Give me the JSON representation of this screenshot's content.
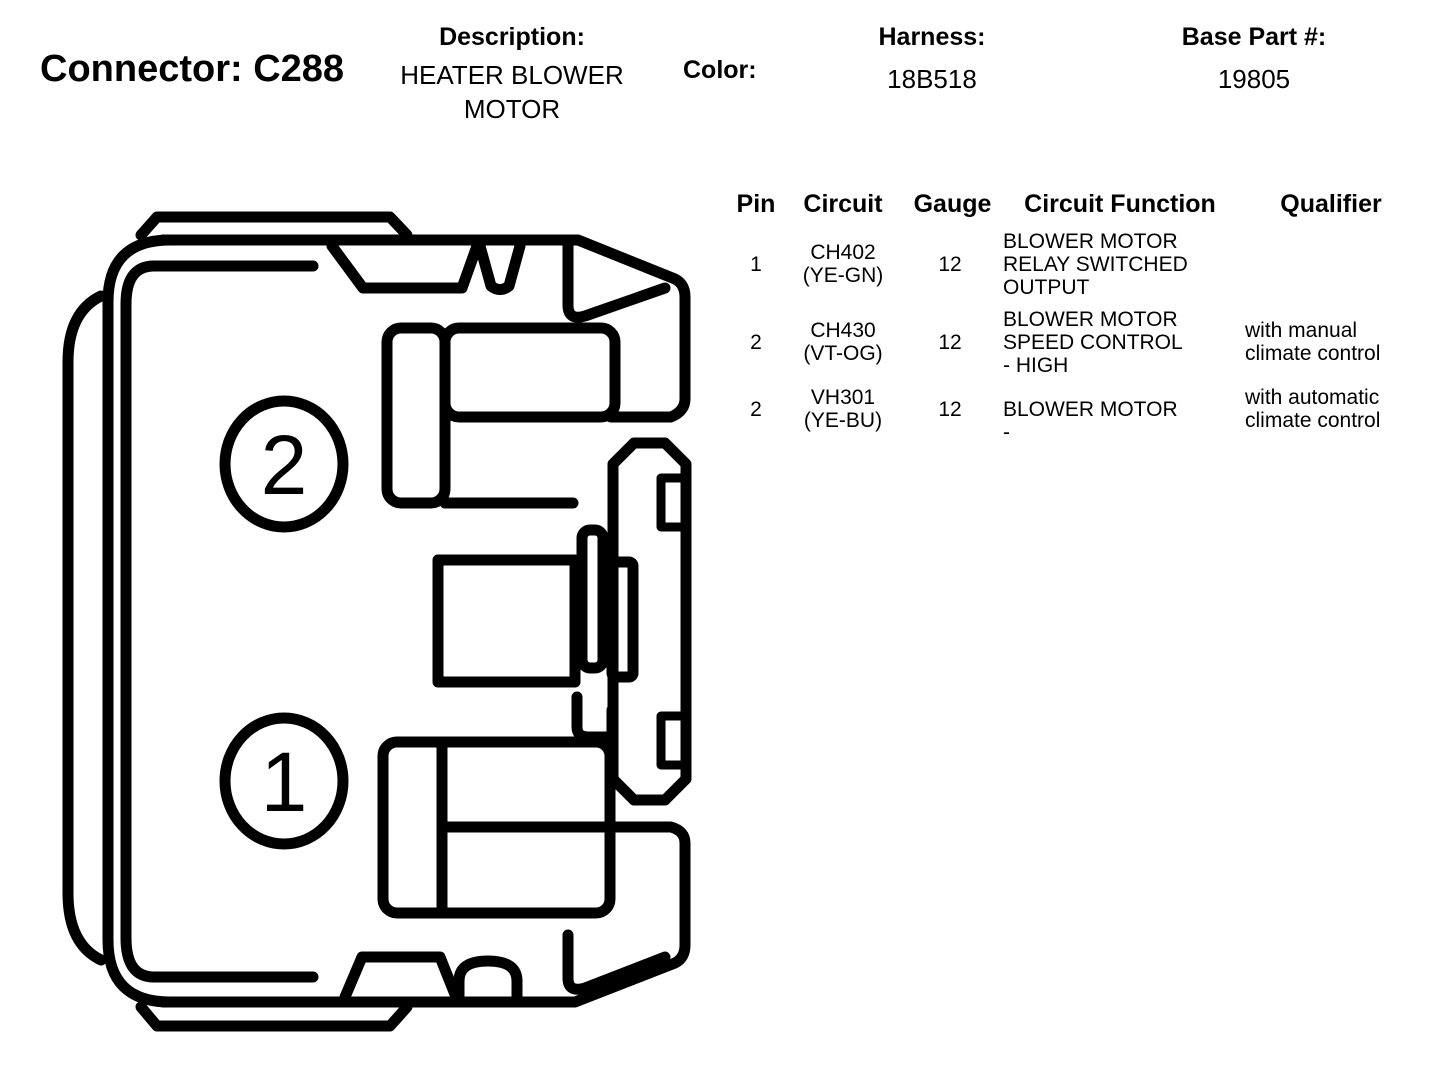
{
  "header": {
    "connector_label": "Connector: C288",
    "description_label": "Description:",
    "description_value": "HEATER BLOWER MOTOR",
    "color_label": "Color:",
    "harness_label": "Harness:",
    "harness_value": "18B518",
    "base_part_label": "Base Part #:",
    "base_part_value": "19805"
  },
  "pin_table": {
    "columns": [
      "Pin",
      "Circuit",
      "Gauge",
      "Circuit Function",
      "Qualifier"
    ],
    "rows": [
      {
        "pin": "1",
        "circuit": "CH402",
        "circuit_color": "(YE-GN)",
        "gauge": "12",
        "function": "BLOWER MOTOR RELAY SWITCHED OUTPUT",
        "qualifier": ""
      },
      {
        "pin": "2",
        "circuit": "CH430",
        "circuit_color": "(VT-OG)",
        "gauge": "12",
        "function": "BLOWER MOTOR SPEED CONTROL - HIGH",
        "qualifier": "with manual climate control"
      },
      {
        "pin": "2",
        "circuit": "VH301",
        "circuit_color": "(YE-BU)",
        "gauge": "12",
        "function": "BLOWER MOTOR -",
        "qualifier": "with automatic climate control"
      }
    ]
  },
  "diagram": {
    "pin_labels": [
      "2",
      "1"
    ],
    "line_color": "#000000",
    "background": "#ffffff"
  }
}
